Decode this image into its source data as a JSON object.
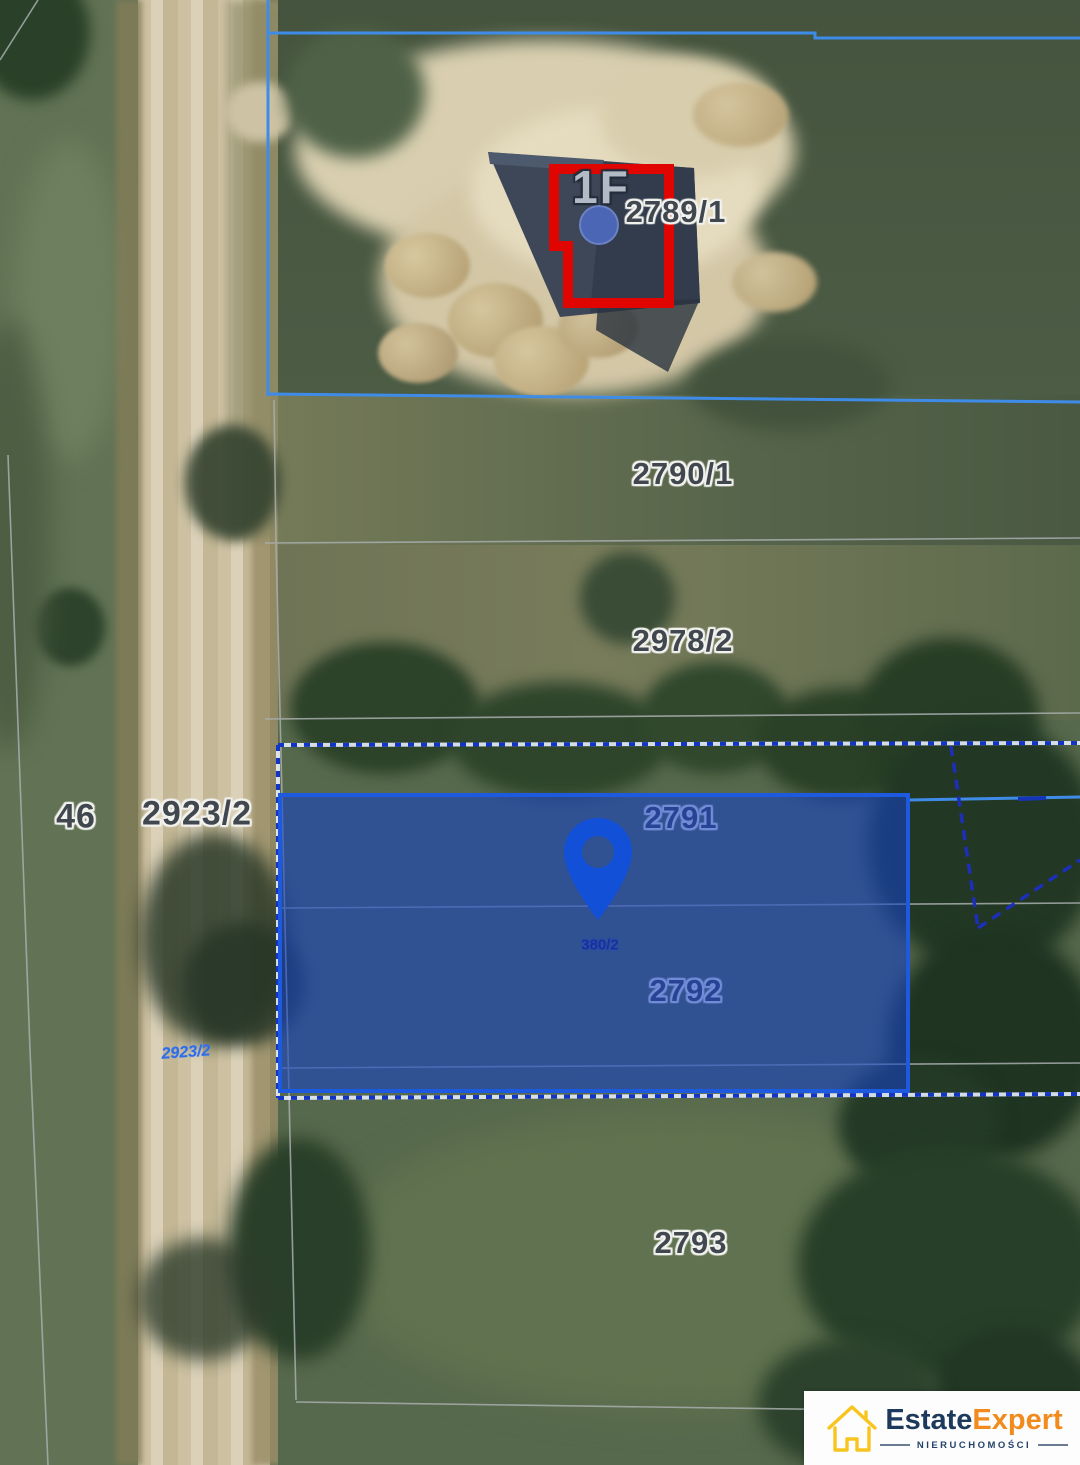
{
  "map": {
    "labels": {
      "p2789_1": "2789/1",
      "p2790_1": "2790/1",
      "p2978_2": "2978/2",
      "p2791": "2791",
      "p2792": "2792",
      "p2793": "2793",
      "p2923_2": "2923/2",
      "p46": "46",
      "road_small": "2923/2",
      "pin_small": "380/2",
      "building_floor": "1F"
    },
    "colors": {
      "highlight_parcel_fill": "#1543c8",
      "highlight_parcel_border": "#1d5ae0",
      "parcel_boundary_blue": "#3f8ce8",
      "dotted_boundary_navy": "#1335c5",
      "building_outline_red": "#e00500",
      "pin_blue": "#1250d8",
      "cadastral_line_grey": "#a8aeae"
    }
  },
  "logo": {
    "brand_primary": "Estate",
    "brand_secondary": "Expert",
    "tagline": "NIERUCHOMOŚCI"
  }
}
